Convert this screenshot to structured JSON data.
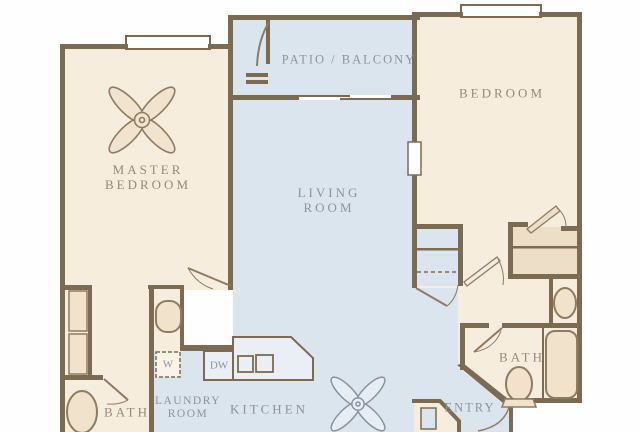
{
  "title": "Two bedroom apartment floor plan",
  "colors": {
    "wall": "#7c6b53",
    "room_warm": "#f7eddd",
    "room_cool": "#dbe5ee",
    "fixture_fill": "#f0e2cb",
    "closet_fill": "#ecdec7",
    "counter_fill": "#e9eff5",
    "label_warm": "#97897a",
    "label_cool": "#8d939d"
  },
  "rooms": {
    "master_bedroom": {
      "line1": "MASTER",
      "line2": "BEDROOM"
    },
    "living_room": {
      "line1": "LIVING",
      "line2": "ROOM"
    },
    "bedroom": {
      "label": "BEDROOM"
    },
    "patio": {
      "label": "PATIO / BALCONY"
    },
    "kitchen": {
      "label": "KITCHEN"
    },
    "laundry_room": {
      "line1": "LAUNDRY",
      "line2": "ROOM"
    },
    "master_bath": {
      "label": "BATH"
    },
    "bath": {
      "label": "BATH"
    },
    "entry": {
      "label": "ENTRY"
    }
  },
  "appliances": {
    "washer": "W",
    "dishwasher": "DW"
  },
  "icons": [
    "ceiling-fan-icon",
    "toilet-icon",
    "bathtub-icon",
    "sink-icon",
    "kitchen-sink-icon",
    "closet-doors-icon"
  ]
}
